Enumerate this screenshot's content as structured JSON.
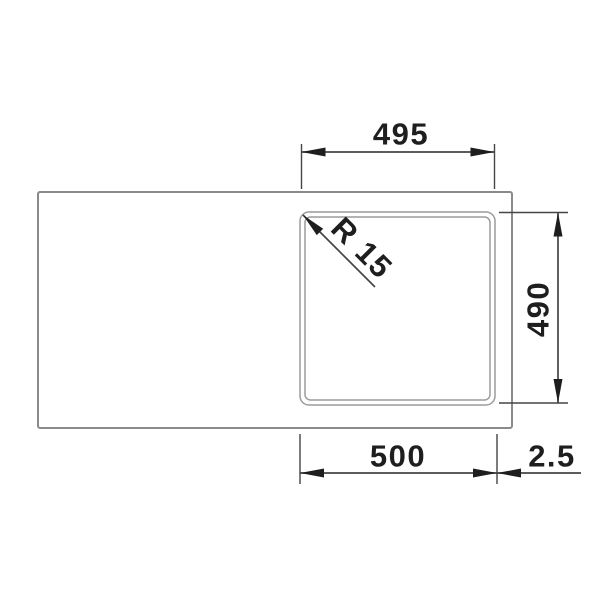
{
  "drawing": {
    "description": "Technical top-view dimension drawing of a kitchen sink with one square bowl and drainboard area",
    "labels": {
      "top_width": "495",
      "right_height": "490",
      "bottom_width": "500",
      "edge_offset": "2.5",
      "corner_radius": "R 15"
    },
    "colors": {
      "background": "#ffffff",
      "sink_outline": "#8a8a8a",
      "bowl_outline": "#9c9c9c",
      "dimension_lines": "#454545",
      "text_and_arrows": "#1e1e1e"
    }
  }
}
